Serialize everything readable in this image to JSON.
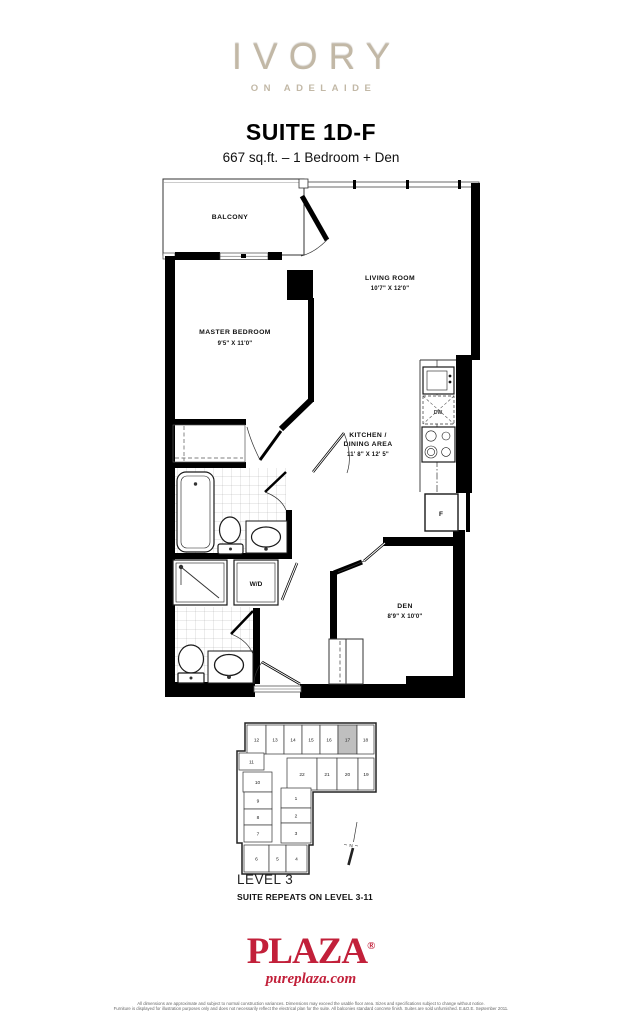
{
  "header": {
    "brand": "IVORY",
    "brand_tagline": "ON ADELAIDE",
    "suite_title": "SUITE 1D-F",
    "suite_subtitle": "667 sq.ft. – 1 Bedroom + Den"
  },
  "floorplan": {
    "balcony": {
      "label": "BALCONY"
    },
    "living_room": {
      "label": "LIVING ROOM",
      "dims": "10'7\" X 12'0\""
    },
    "master_bedroom": {
      "label": "MASTER BEDROOM",
      "dims": "9'5\" X 11'0\""
    },
    "kitchen": {
      "label_line1": "KITCHEN /",
      "label_line2": "DINING AREA",
      "dims": "11' 8\" X 12' 5\""
    },
    "den": {
      "label": "DEN",
      "dims": "8'9\" X 10'0\""
    },
    "fixtures": {
      "fridge": "F",
      "washer_dryer": "W/D",
      "dishwasher": "DW"
    }
  },
  "keyplan": {
    "level_label": "LEVEL 3",
    "repeat_note": "SUITE REPEATS ON LEVEL 3-11",
    "north_label": "N",
    "highlighted_unit": "17",
    "highlight_color": "#bfbfbf",
    "units": [
      {
        "n": "12",
        "x": 17,
        "y": 13,
        "w": 19,
        "h": 29
      },
      {
        "n": "13",
        "x": 36,
        "y": 13,
        "w": 18,
        "h": 29
      },
      {
        "n": "14",
        "x": 54,
        "y": 13,
        "w": 18,
        "h": 29
      },
      {
        "n": "15",
        "x": 72,
        "y": 13,
        "w": 18,
        "h": 29
      },
      {
        "n": "16",
        "x": 90,
        "y": 13,
        "w": 18,
        "h": 29
      },
      {
        "n": "17",
        "x": 108,
        "y": 13,
        "w": 19,
        "h": 29,
        "highlight": true
      },
      {
        "n": "18",
        "x": 127,
        "y": 13,
        "w": 17,
        "h": 29
      },
      {
        "n": "11",
        "x": 9,
        "y": 41,
        "w": 25,
        "h": 17
      },
      {
        "n": "22",
        "x": 57,
        "y": 46,
        "w": 30,
        "h": 32
      },
      {
        "n": "21",
        "x": 87,
        "y": 46,
        "w": 20,
        "h": 32
      },
      {
        "n": "20",
        "x": 107,
        "y": 46,
        "w": 21,
        "h": 32
      },
      {
        "n": "19",
        "x": 128,
        "y": 46,
        "w": 16,
        "h": 32
      },
      {
        "n": "10",
        "x": 13,
        "y": 60,
        "w": 29,
        "h": 20
      },
      {
        "n": "9",
        "x": 14,
        "y": 80,
        "w": 28,
        "h": 17
      },
      {
        "n": "8",
        "x": 14,
        "y": 97,
        "w": 28,
        "h": 16
      },
      {
        "n": "7",
        "x": 14,
        "y": 113,
        "w": 28,
        "h": 17
      },
      {
        "n": "1",
        "x": 51,
        "y": 76,
        "w": 30,
        "h": 20
      },
      {
        "n": "2",
        "x": 51,
        "y": 96,
        "w": 30,
        "h": 15
      },
      {
        "n": "3",
        "x": 51,
        "y": 111,
        "w": 30,
        "h": 20
      },
      {
        "n": "6",
        "x": 14,
        "y": 133,
        "w": 25,
        "h": 27
      },
      {
        "n": "5",
        "x": 39,
        "y": 133,
        "w": 17,
        "h": 27
      },
      {
        "n": "4",
        "x": 56,
        "y": 133,
        "w": 21,
        "h": 27
      }
    ]
  },
  "footer": {
    "logo_text": "PLAZA",
    "registered_mark": "®",
    "website": "pureplaza.com",
    "logo_color": "#c2203a",
    "disclaimer_line1": "All dimensions are approximate and subject to normal construction variances. Dimensions may exceed the usable floor area. Sizes and specifications subject to change without notice.",
    "disclaimer_line2": "Furniture is displayed for illustration purposes only and does not necessarily reflect the electrical plan for the suite. All balconies standard concrete finish. Suites are sold unfurnished. E.&O.E. September 2011."
  }
}
